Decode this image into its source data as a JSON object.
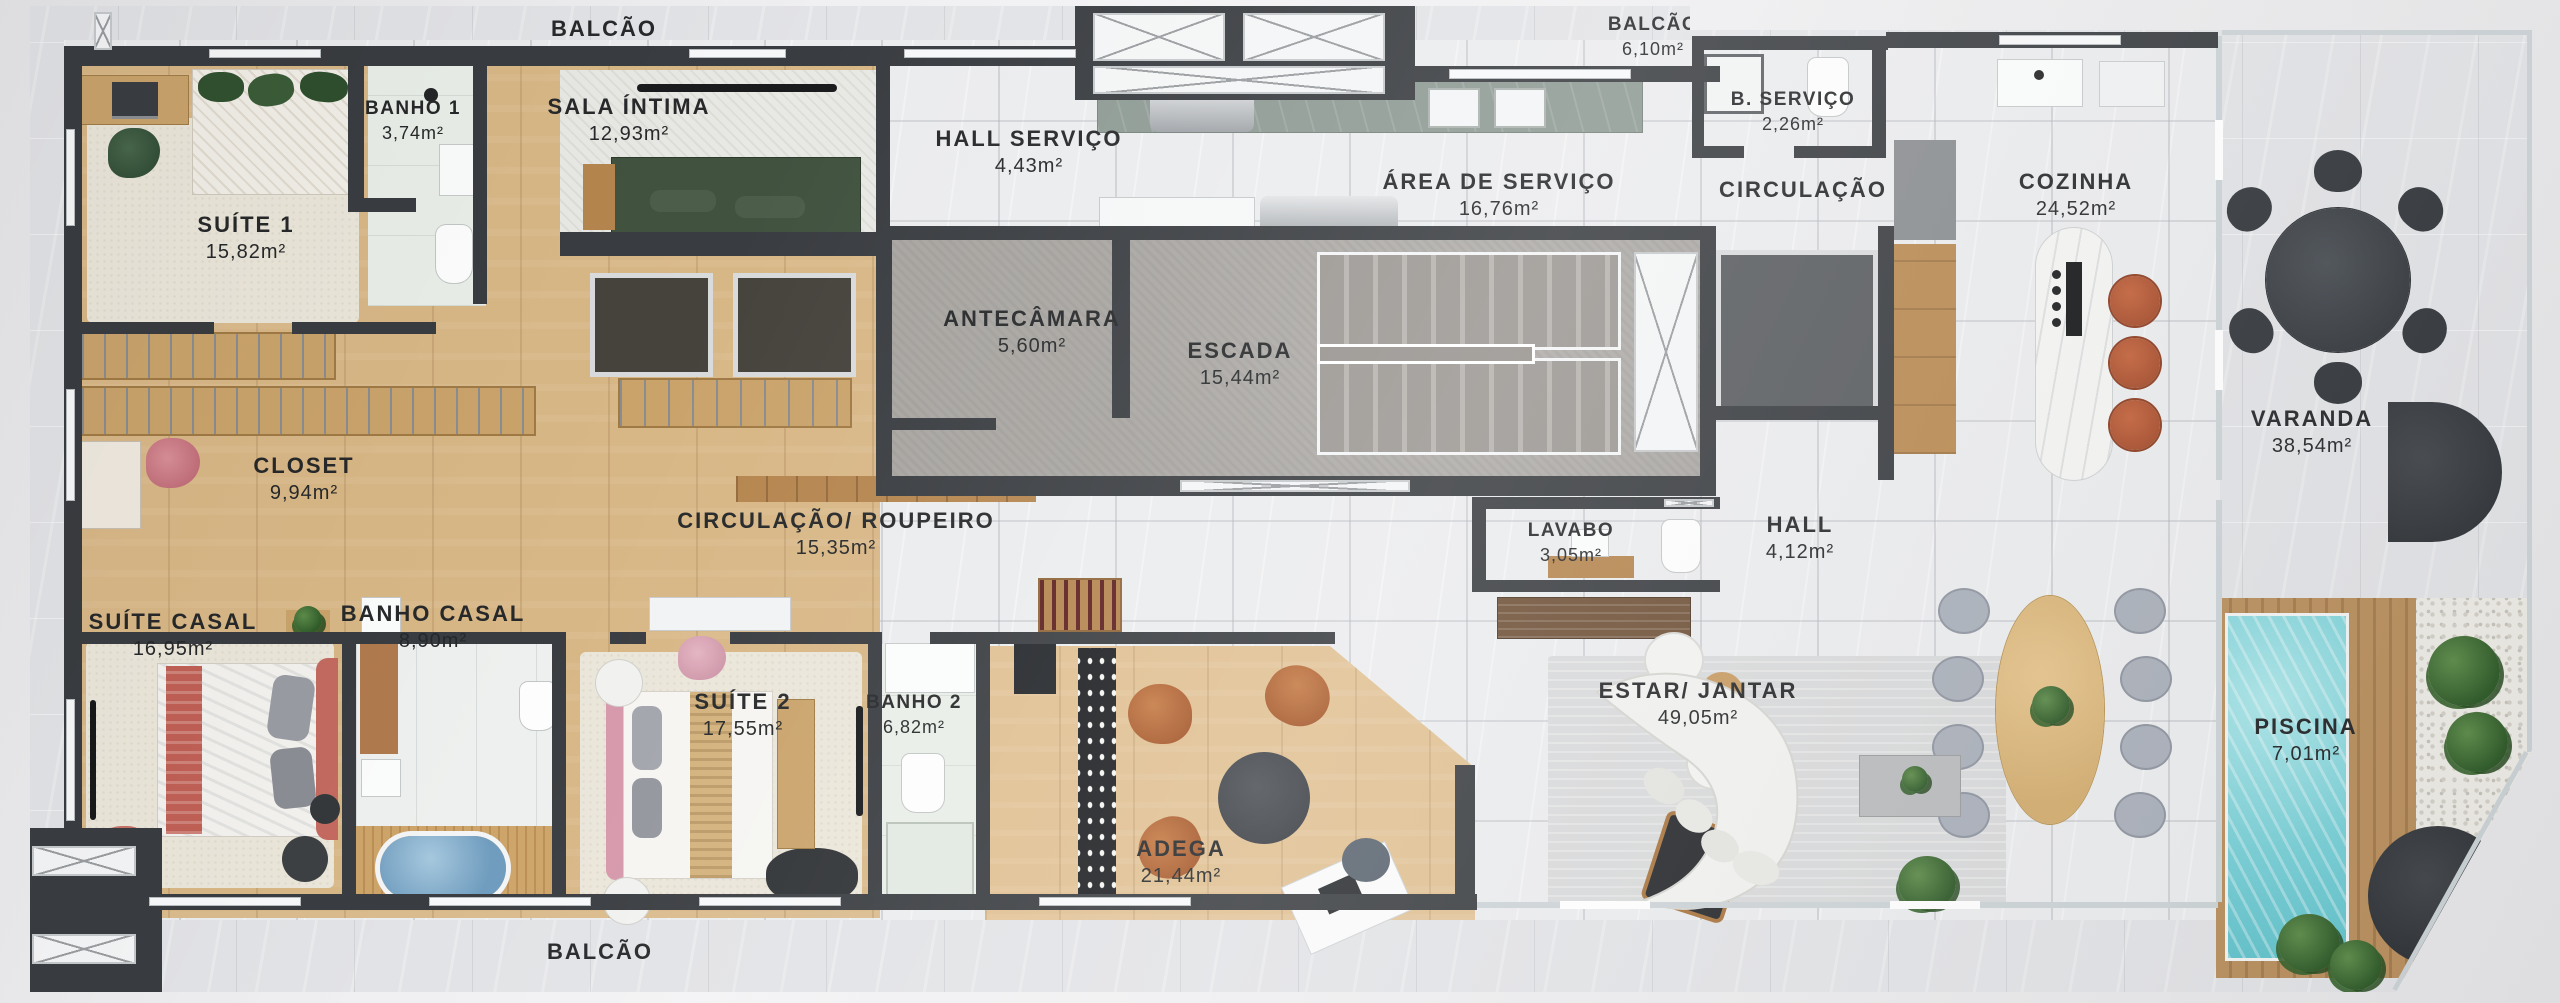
{
  "plan_type": "apartment-floor-plan",
  "palette": {
    "wall": "#393c40",
    "wood_floor": "#d8b786",
    "adega_wood": "#e0c092",
    "interior_marble": "#ebecee",
    "exterior_marble": "#e2e3e6",
    "concrete": "#a8a5a1",
    "pool_water": "#79d0d7",
    "deck_wood": "#b98f5e",
    "sofa_green": "#41523f",
    "bed_coral": "#c06055",
    "suite2_pink": "#d698ab",
    "leather_cognac": "#b4622f",
    "stool_rust": "#b0512f",
    "dining_chair_gray": "#aab0ba",
    "label_text": "#26282a"
  },
  "rooms": [
    {
      "id": "balcao-top",
      "name": "BALCÃO",
      "area": ""
    },
    {
      "id": "banho-1",
      "name": "BANHO 1",
      "area": "3,74m²"
    },
    {
      "id": "sala-intima",
      "name": "SALA ÍNTIMA",
      "area": "12,93m²"
    },
    {
      "id": "suite-1",
      "name": "SUÍTE 1",
      "area": "15,82m²"
    },
    {
      "id": "hall-servico",
      "name": "HALL SERVIÇO",
      "area": "4,43m²"
    },
    {
      "id": "balcao-servico",
      "name": "BALCÃO",
      "area": "6,10m²"
    },
    {
      "id": "b-servico",
      "name": "B. SERVIÇO",
      "area": "2,26m²"
    },
    {
      "id": "area-de-servico",
      "name": "ÁREA DE SERVIÇO",
      "area": "16,76m²"
    },
    {
      "id": "circulacao",
      "name": "CIRCULAÇÃO",
      "area": ""
    },
    {
      "id": "cozinha",
      "name": "COZINHA",
      "area": "24,52m²"
    },
    {
      "id": "antecamara",
      "name": "ANTECÂMARA",
      "area": "5,60m²"
    },
    {
      "id": "escada",
      "name": "ESCADA",
      "area": "15,44m²"
    },
    {
      "id": "varanda",
      "name": "VARANDA",
      "area": "38,54m²"
    },
    {
      "id": "closet",
      "name": "CLOSET",
      "area": "9,94m²"
    },
    {
      "id": "circulacao-roupeiro",
      "name": "CIRCULAÇÃO/ ROUPEIRO",
      "area": "15,35m²"
    },
    {
      "id": "lavabo",
      "name": "LAVABO",
      "area": "3,05m²"
    },
    {
      "id": "hall",
      "name": "HALL",
      "area": "4,12m²"
    },
    {
      "id": "suite-casal",
      "name": "SUÍTE CASAL",
      "area": "16,95m²"
    },
    {
      "id": "banho-casal",
      "name": "BANHO CASAL",
      "area": "8,90m²"
    },
    {
      "id": "suite-2",
      "name": "SUÍTE 2",
      "area": "17,55m²"
    },
    {
      "id": "banho-2",
      "name": "BANHO 2",
      "area": "6,82m²"
    },
    {
      "id": "adega",
      "name": "ADEGA",
      "area": "21,44m²"
    },
    {
      "id": "estar-jantar",
      "name": "ESTAR/ JANTAR",
      "area": "49,05m²"
    },
    {
      "id": "piscina",
      "name": "PISCINA",
      "area": "7,01m²"
    },
    {
      "id": "balcao-bottom",
      "name": "BALCÃO",
      "area": ""
    }
  ]
}
